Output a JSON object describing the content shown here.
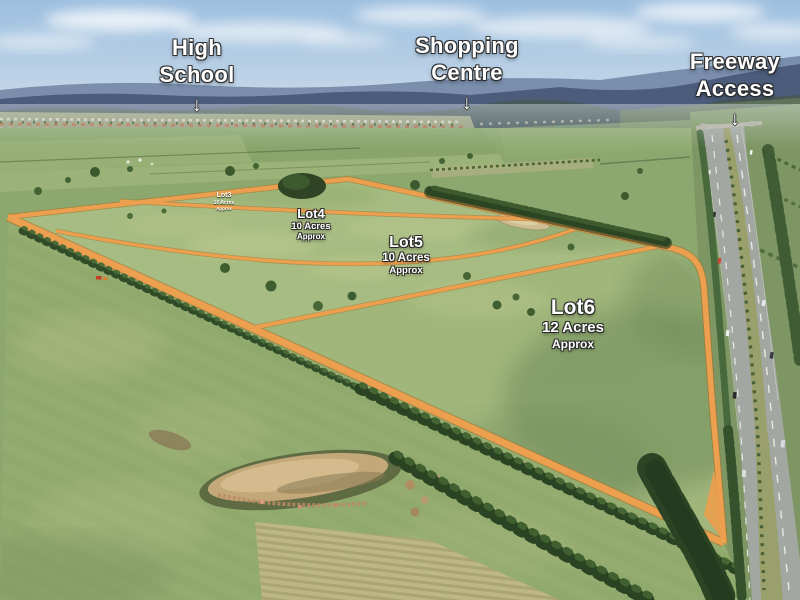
{
  "annotations": {
    "locations": [
      {
        "id": "high-school",
        "line1": "High",
        "line2": "School",
        "arrow": "↓"
      },
      {
        "id": "shopping-centre",
        "line1": "Shopping",
        "line2": "Centre",
        "arrow": "↓"
      },
      {
        "id": "freeway-access",
        "line1": "Freeway",
        "line2": "Access",
        "arrow": "↓"
      }
    ],
    "lots": [
      {
        "name": "Lot3",
        "size": "10 Acres",
        "qualifier": "Approx"
      },
      {
        "name": "Lot4",
        "size": "10 Acres",
        "qualifier": "Approx"
      },
      {
        "name": "Lot5",
        "size": "10 Acres",
        "qualifier": "Approx"
      },
      {
        "name": "Lot6",
        "size": "12 Acres",
        "qualifier": "Approx"
      }
    ]
  },
  "colors": {
    "boundary_orange": "#EC9F4E",
    "label_text": "#FFFFFF"
  }
}
